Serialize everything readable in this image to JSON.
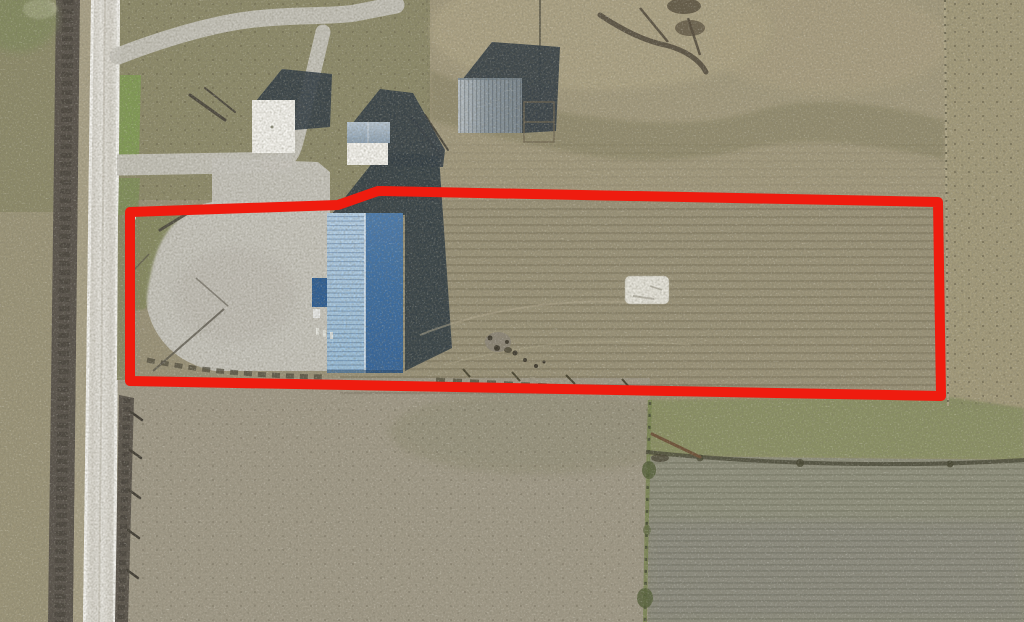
{
  "image": {
    "title": "Aerial drone photo of rural property with red parcel outline",
    "description": "Top-down aerial photo: paved road on left, farmstead with white house, gray metal barn, small shed and a large blue-roofed outbuilding with gravel lot; a thick red polygon outlines the listed parcel containing the blue building, gravel lot and open field",
    "annotation": {
      "parcel_outline_points": "130,212 338,205 378,191 938,202 941,396 130,381",
      "stroke_width": "10"
    },
    "colors": {
      "outline_red": "#ef1c0f",
      "field_base": "#9c9579",
      "field_top_left": "#8d8a69",
      "field_top_mid": "#a39a7e",
      "field_right_rough": "#a89f7e",
      "field_parcel": "#9b9379",
      "field_bottom_left": "#a19a88",
      "field_bottom_right": "#90907e",
      "green_band": "#8a9163",
      "roadside_green": "#7f9b53",
      "road_surface": "#e4e2da",
      "road_edge_line": "#f6f5f1",
      "shoulder_brush": "#57514a",
      "shoulder_tan": "#aaa288",
      "gravel": "#c9c7c0",
      "shadow": "#323d45",
      "blue_roof_light": "#a9c9e4",
      "blue_roof_dark": "#3a6ca2",
      "lean_to_blue": "#2b5c94",
      "barn_roof_gray": "#93a0a8",
      "shed_roof_blue_gray": "#a2b6c8",
      "white_walls": "#f6f5f0",
      "white_pad": "#e7e5dc",
      "hedge_dark": "#4a4a38",
      "fence_green": "#77854e",
      "debris_dark": "#46422f"
    }
  }
}
